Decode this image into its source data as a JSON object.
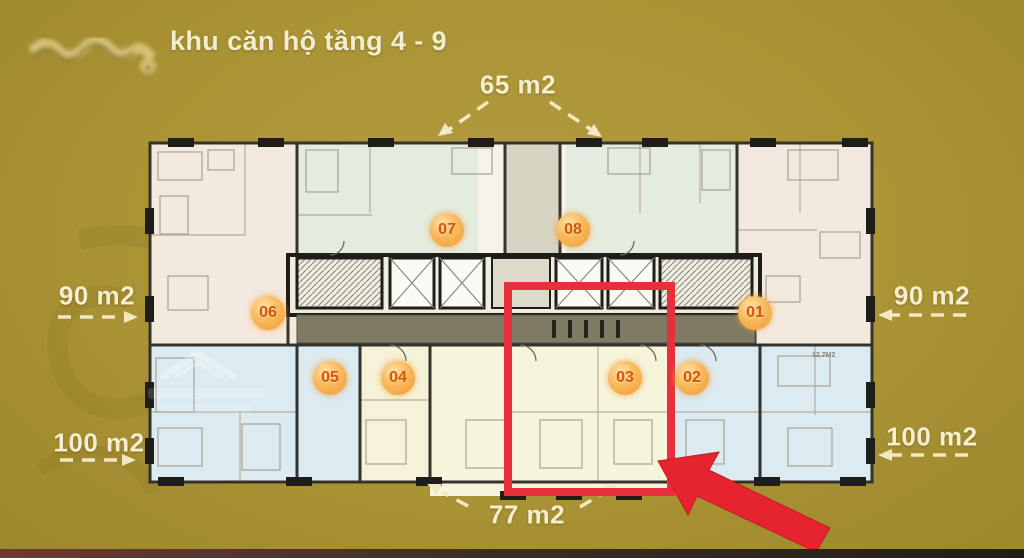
{
  "title": "khu căn hộ tầng 4 - 9",
  "area_labels": {
    "top": "65 m2",
    "left_mid": "90 m2",
    "left_low": "100 m2",
    "right_mid": "90 m2",
    "right_low": "100 m2",
    "bottom": "77 m2"
  },
  "unit_badges": [
    {
      "label": "01"
    },
    {
      "label": "02"
    },
    {
      "label": "03"
    },
    {
      "label": "04"
    },
    {
      "label": "05"
    },
    {
      "label": "06"
    },
    {
      "label": "07"
    },
    {
      "label": "08"
    }
  ],
  "room_note": "12.7M2",
  "colors": {
    "background": "#aa9334",
    "label_text": "#f5eecf",
    "highlight_red": "#e8303c",
    "badge_orange": "#f6a93f"
  }
}
